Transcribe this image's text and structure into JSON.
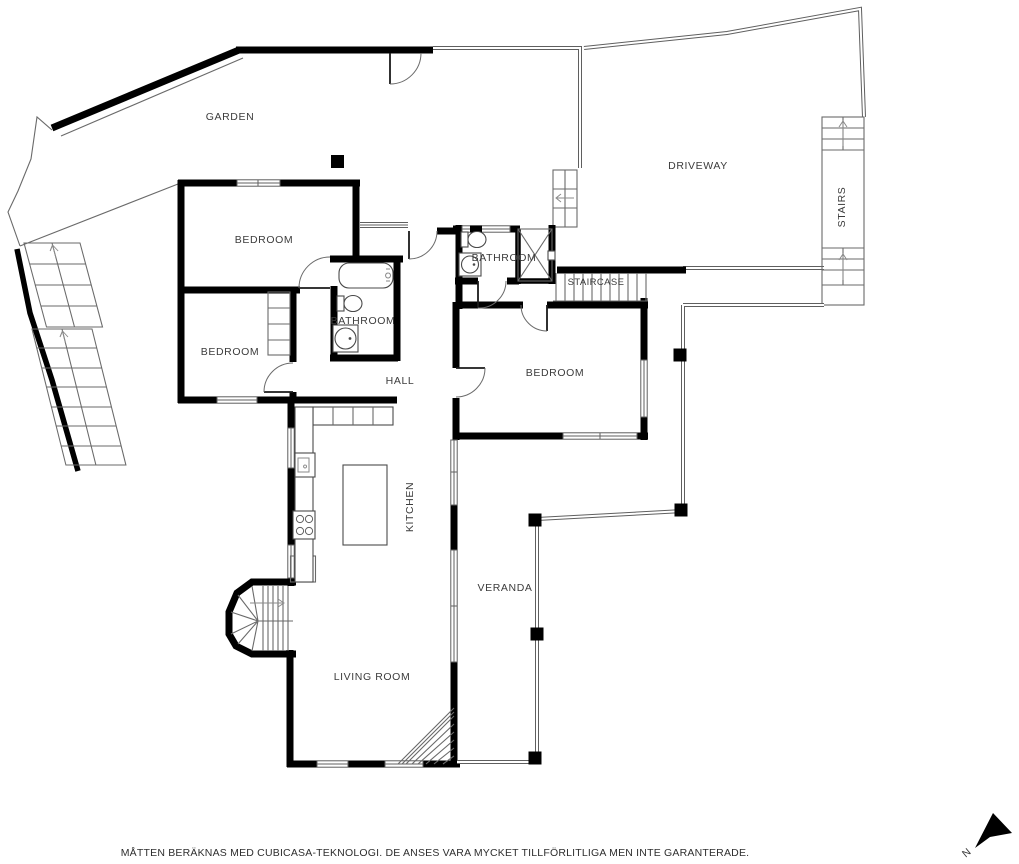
{
  "labels": {
    "garden": "GARDEN",
    "driveway": "DRIVEWAY",
    "stairs": "STAIRS",
    "bedroom1": "BEDROOM",
    "bathroom2": "BATHROOM",
    "staircase": "STAIRCASE",
    "bathroom1": "BATHROOM",
    "bedroom2": "BEDROOM",
    "bedroom3": "BEDROOM",
    "hall": "HALL",
    "kitchen": "KITCHEN",
    "veranda": "VERANDA",
    "living_room": "LIVING ROOM",
    "compass_north": "N"
  },
  "footer": {
    "disclaimer": "MÅTTEN BERÄKNAS MED CUBICASA-TEKNOLOGI. DE ANSES VARA MYCKET TILLFÖRLITLIGA MEN INTE GARANTERADE."
  },
  "colors": {
    "wall": "#000000",
    "thin_line": "#6a6a6a",
    "label": "#3c3c3c",
    "background": "#ffffff"
  }
}
